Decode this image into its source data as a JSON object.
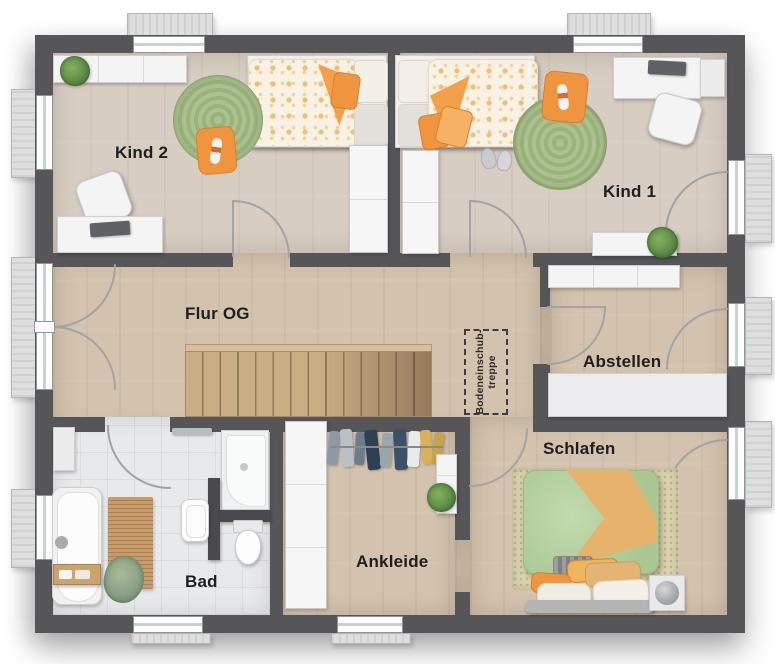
{
  "rooms": {
    "kind2": {
      "label": "Kind 2"
    },
    "kind1": {
      "label": "Kind 1"
    },
    "flur_og": {
      "label": "Flur OG"
    },
    "abstellen": {
      "label": "Abstellen"
    },
    "bad": {
      "label": "Bad"
    },
    "ankleide": {
      "label": "Ankleide"
    },
    "schlafen": {
      "label": "Schlafen"
    }
  },
  "annotations": {
    "attic_stairs": {
      "line1": "Bodeneinschub-",
      "line2": "treppe"
    }
  },
  "palette": {
    "wall": "#565659",
    "wood_floor": "#d7cdc2",
    "hall_floor": "#d3c3ae",
    "tile_floor": "#e8e9eb",
    "stair_wood": "#c9ad85",
    "rug_green": "#a9c08d",
    "accent_orange": "#f0953f",
    "bed_green": "#b9d3a3",
    "furniture_white": "#f4f4f4",
    "dark_fixture": "#4a4a4e",
    "label_color": "#1f1f1f"
  }
}
